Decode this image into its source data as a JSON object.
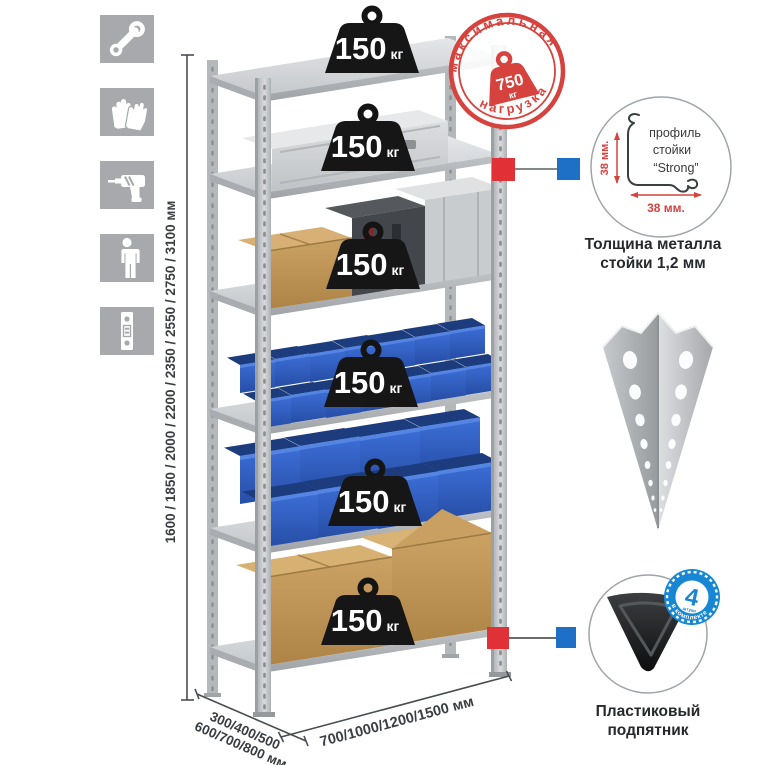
{
  "title": "Стеллаж металлический — схема нагрузок и размеров",
  "sidebar": {
    "tile_color": "#a7a9ac",
    "items": [
      {
        "icon": "wrench-icon"
      },
      {
        "icon": "gloves-icon"
      },
      {
        "icon": "drill-icon"
      },
      {
        "icon": "person-icon"
      },
      {
        "icon": "rack-post-icon"
      }
    ]
  },
  "rack": {
    "shelf_count": 6,
    "shelves": [
      {
        "value": "150",
        "unit": "кг"
      },
      {
        "value": "150",
        "unit": "кг"
      },
      {
        "value": "150",
        "unit": "кг"
      },
      {
        "value": "150",
        "unit": "кг"
      },
      {
        "value": "150",
        "unit": "кг"
      },
      {
        "value": "150",
        "unit": "кг"
      }
    ]
  },
  "stamp": {
    "arc_top": "максимальная",
    "arc_bottom": "нагрузка",
    "value": "750",
    "unit": "кг",
    "color": "#d6433e"
  },
  "dims": {
    "height": "1600 / 1850 / 2000 / 2200 / 2350 / 2550 / 2750 / 3100 мм",
    "depth1": "300/400/500",
    "depth2": "600/700/800 мм",
    "width": "700/1000/1200/1500 мм"
  },
  "profile": {
    "l1": "профиль",
    "l2": "стойки",
    "l3": "“Strong”",
    "dim_v": "38 мм.",
    "dim_h": "38 мм.",
    "cap1": "Толщина металла",
    "cap2": "стойки 1,2 мм"
  },
  "foot": {
    "badge_value": "4",
    "badge_small": "штуки",
    "badge_arc": "в комплекте",
    "badge_color": "#1787d3",
    "cap1": "Пластиковый",
    "cap2": "подпятник"
  },
  "colors": {
    "accent_red": "#e03236",
    "accent_blue": "#1d70c6",
    "bin_blue": "#2d5fc2",
    "metal_gray": "#c6c9cc",
    "cardboard": "#c49759",
    "badge_black": "#161616"
  }
}
